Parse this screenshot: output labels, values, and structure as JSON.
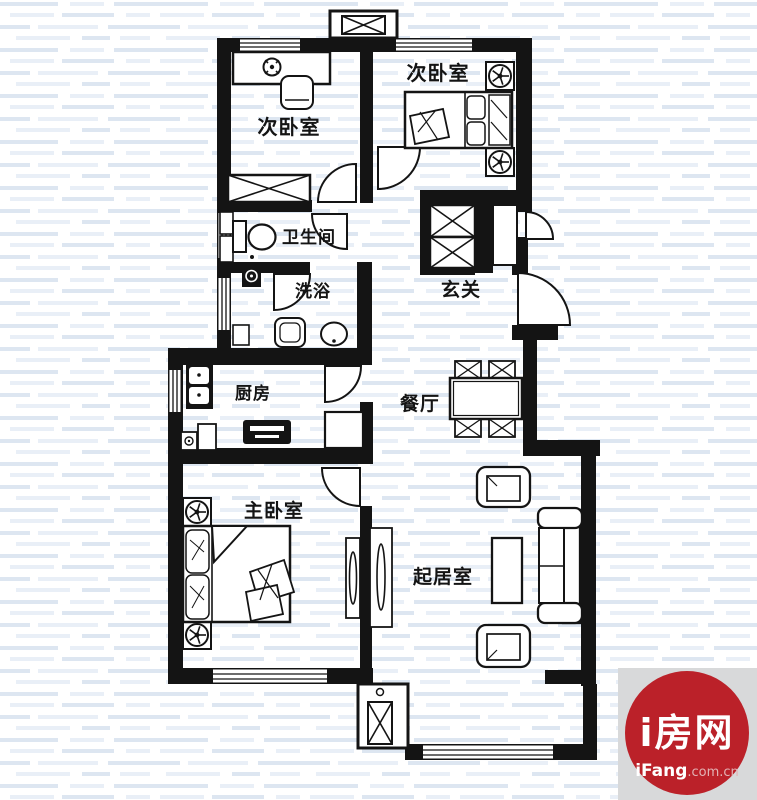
{
  "rooms": {
    "bedroom_left": {
      "label": "次卧室"
    },
    "bedroom_right": {
      "label": "次卧室"
    },
    "bathroom": {
      "label": "卫生间"
    },
    "shower": {
      "label": "洗浴"
    },
    "entry": {
      "label": "玄关"
    },
    "kitchen": {
      "label": "厨房"
    },
    "dining": {
      "label": "餐厅"
    },
    "master_bedroom": {
      "label": "主卧室"
    },
    "living": {
      "label": "起居室"
    }
  },
  "watermark": {
    "brand": "i房网",
    "site_bold": "iFang",
    "site_suffix": ".com.cn",
    "circle_color": "#bb2129",
    "square_color": "#d8d9da",
    "brand_text_color": "#ffffff",
    "suffix_text_color": "#e2b2b4"
  },
  "colors": {
    "line": "#141414",
    "stripe_dark": "#dde6f1",
    "stripe_light": "#e9eff7",
    "background": "#ffffff"
  }
}
